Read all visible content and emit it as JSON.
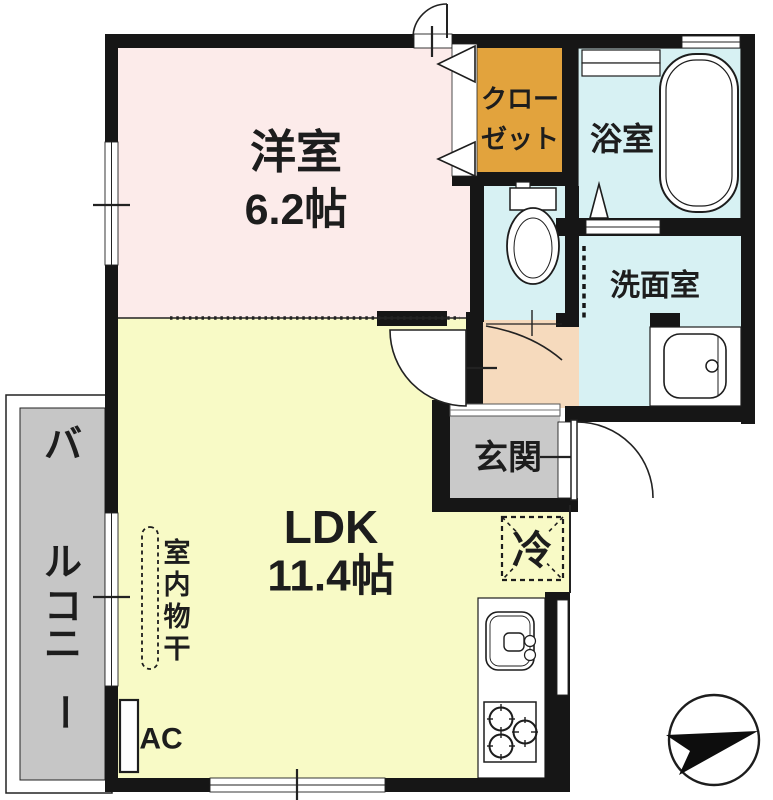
{
  "plan": {
    "western_room": {
      "name": "洋室",
      "size": "6.2帖"
    },
    "closet": {
      "line1": "クロー",
      "line2": "ゼット"
    },
    "bathroom": {
      "name": "浴室"
    },
    "washroom": {
      "name": "洗面室"
    },
    "entrance": {
      "name": "玄関"
    },
    "ldk": {
      "name": "LDK",
      "size": "11.4帖"
    },
    "balcony": {
      "name": "バルコニー"
    },
    "labels": {
      "refrigerator": "冷",
      "indoor_drying": "室内物干",
      "air_conditioner": "AC"
    }
  },
  "colors": {
    "wall": "#161616",
    "line": "#222222",
    "western_room": "#fcebea",
    "ldk": "#f8fac6",
    "wet_area": "#d7f1f3",
    "closet": "#e2a33d",
    "hallway": "#f6dabd",
    "entrance_floor": "#c9c9c9",
    "balcony_floor": "#c6c6c6",
    "fixture_fill": "#ffffff"
  }
}
